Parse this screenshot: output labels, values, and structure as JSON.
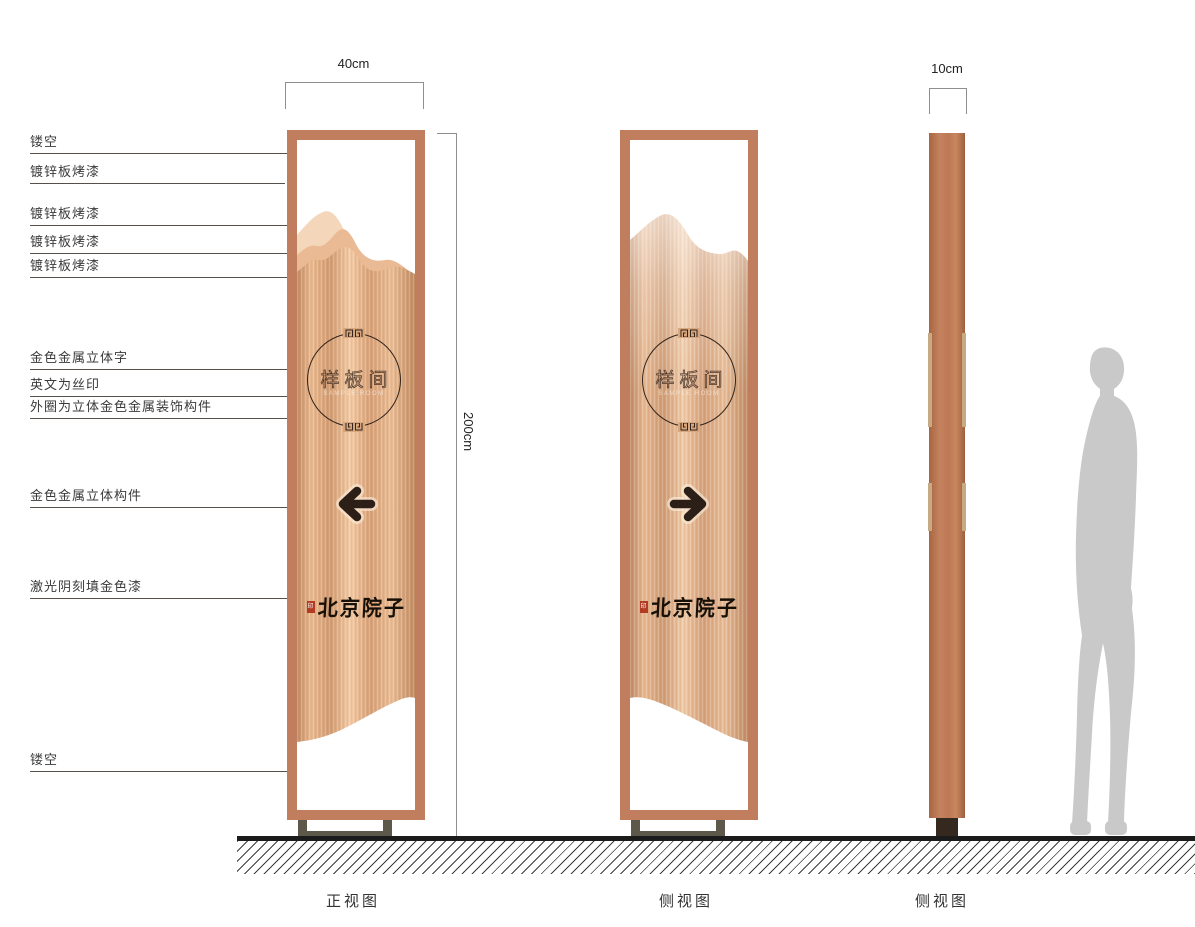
{
  "dimensions": {
    "front_width": "40cm",
    "side_width": "10cm",
    "height": "200cm"
  },
  "annotations": [
    {
      "label": "镂空"
    },
    {
      "label": "镀锌板烤漆"
    },
    {
      "label": "镀锌板烤漆"
    },
    {
      "label": "镀锌板烤漆"
    },
    {
      "label": "镀锌板烤漆"
    },
    {
      "label": "金色金属立体字"
    },
    {
      "label": "英文为丝印"
    },
    {
      "label": "外圈为立体金色金属装饰构件"
    },
    {
      "label": "金色金属立体构件"
    },
    {
      "label": "激光阴刻填金色漆"
    },
    {
      "label": "镂空"
    }
  ],
  "front_view": {
    "sign_text": "样板间",
    "english_caption": "SAMPLE ROOM",
    "brand_text": "北京院子",
    "seal_text": "印",
    "arrow_direction": "left",
    "view_label": "正视图"
  },
  "back_view": {
    "sign_text": "样板间",
    "english_caption": "SAMPLE ROOM",
    "brand_text": "北京院子",
    "seal_text": "印",
    "arrow_direction": "right",
    "view_label": "侧视图"
  },
  "side_view": {
    "view_label": "侧视图"
  },
  "colors": {
    "frame_copper": "#c17e5e",
    "copper_light": "#f2cba6",
    "copper_dark": "#c08a64",
    "mountain_back": "#f4d6ba",
    "mountain_mid": "#eaba94",
    "detail_dark": "#2b1f17",
    "base_olive": "#5c584a",
    "seal_red": "#b23b24",
    "silhouette_gray": "#c9c9c9"
  }
}
